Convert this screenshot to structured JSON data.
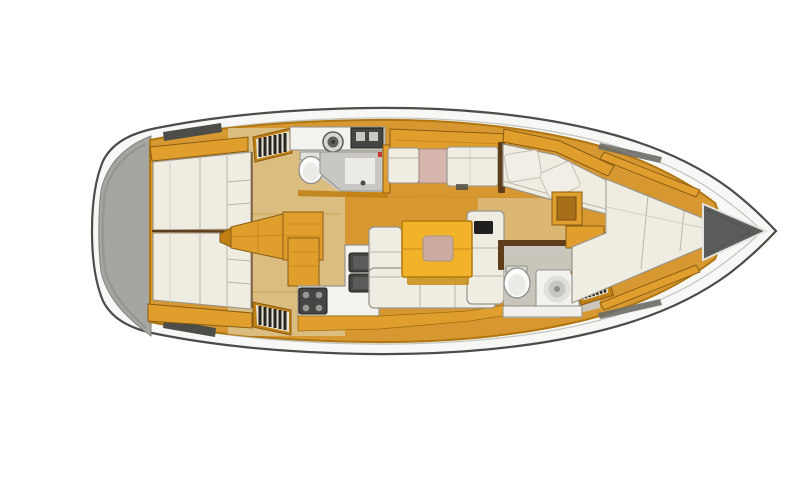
{
  "figure": {
    "type": "sailboat-interior-floorplan",
    "orientation": "bow-right",
    "regions": [
      "transom",
      "aft-cabin-port",
      "aft-cabin-starboard",
      "companionway-steps",
      "aft-head",
      "dinette",
      "chart-table",
      "corner-sofa",
      "salon-table",
      "salon-settee",
      "galley",
      "forward-head",
      "forward-cabin-berth",
      "anchor-locker"
    ]
  },
  "canvas": {
    "width": 810,
    "height": 500
  },
  "colors": {
    "deck_white": "#f7f7f5",
    "transom_gray": "#a5a5a1",
    "strip_gray": "#4c4c48",
    "track_gray": "#6d6d68",
    "floor_amber": "#d89831",
    "floor_tan": "#dcc189",
    "head_floor": "#c8c7c3",
    "cabinet_gray": "#c8c7c3",
    "wood_orange": "#e09f2d",
    "wood_deep": "#c07f12",
    "wood_mid": "#a86f1b",
    "wall_brown": "#5f3d1a",
    "cream": "#efece2",
    "pillow_cream": "#f1eee6",
    "fixture_white": "#f3f2ee",
    "panel_white": "#ededea",
    "toilet_white": "#fbfbf9",
    "toilet_inner": "#ebebe7",
    "appliance_dark": "#454543",
    "appliance_mid": "#5b5b59",
    "burner_gray": "#979793",
    "steel_gray": "#c9c9c4",
    "sink_ring": "#d6d5d1",
    "sink_dark": "#5f5f5b",
    "basin_gray": "#e2e0db",
    "basin_mid": "#c9c7c3",
    "basin_deep": "#8e8e8a",
    "table_yellow": "#f2b32b",
    "table_shadow": "#c78e14",
    "inset_pink": "#cdaaa0",
    "chart_pink": "#d5b5ad",
    "stripe_light": "#e9e3d3",
    "stripe_dark": "#262420",
    "anchor_gray": "#5a5d5a",
    "device_black": "#1f1f1d",
    "pedestal_gray": "#4e4e4a",
    "hinge_gray": "#d8d8d4",
    "tank_gray": "#e1e1dd",
    "accent_red": "#c23b2e"
  }
}
